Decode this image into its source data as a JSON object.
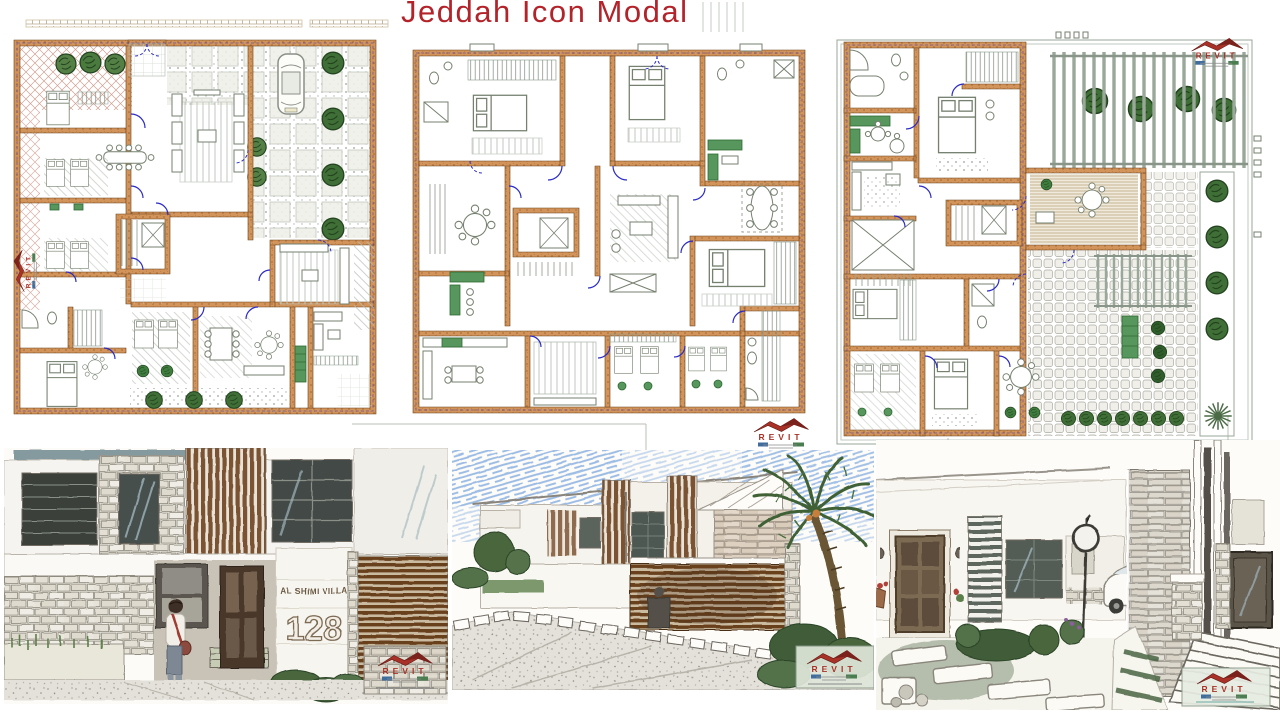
{
  "page": {
    "title": "Jeddah Icon Modal"
  },
  "logo": {
    "text": "REVIT"
  },
  "render_left": {
    "sign_name": "AL SHIMI VILLA",
    "sign_number": "128"
  },
  "sections": {
    "floor_plans": 3,
    "sketch_renders": 3
  },
  "colors": {
    "title_red": "#b3232a",
    "plan_wall_tan": "#d2945a",
    "plan_wall_outline": "#6b4118",
    "door_swing_blue": "#2a2ac8",
    "tree_green": "#548046",
    "dark_tree_green": "#3f6f36",
    "furniture_gray_green": "#75806f",
    "kitchen_counter_green": "#57965d",
    "logo_roof_red": "#a83228",
    "sketch_wood_brown": "#7c5233",
    "sketch_stone_gray": "#8f8b7f",
    "sky_scribble_blue": "#8fb4e2"
  }
}
